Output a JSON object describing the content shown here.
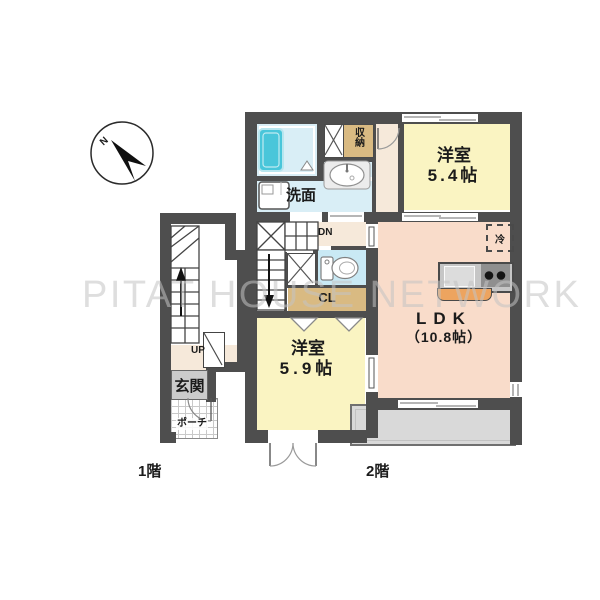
{
  "compass": {
    "label": "N"
  },
  "watermark": {
    "text": "PITAT HOUSE NETWORK"
  },
  "floor1": {
    "label": "1階",
    "stairs": "UP",
    "entrance": "玄関",
    "porch": "ポーチ"
  },
  "floor2": {
    "label": "2階",
    "stairs": "DN",
    "bedroom54": {
      "name": "洋室",
      "size": "5.4帖"
    },
    "bedroom59": {
      "name": "洋室",
      "size": "5.9帖"
    },
    "ldk": {
      "name": "LDK",
      "size": "（10.8帖）"
    },
    "washroom": "洗面",
    "storage": "収納",
    "closet": "CL",
    "fridge": "冷"
  },
  "colors": {
    "wall": "#4e4e4e",
    "bedroom": "#faf4c2",
    "ldk": "#f9dcca",
    "wet_area": "#d9eef6",
    "toilet": "#c9e9f4",
    "closet_fill": "#d9ba82",
    "hall": "#f6e9da",
    "balcony": "#d9d9d9",
    "bathtub": "#49c6da",
    "counter_orange": "#eda45f",
    "entrance_gray": "#cbcbcb"
  }
}
